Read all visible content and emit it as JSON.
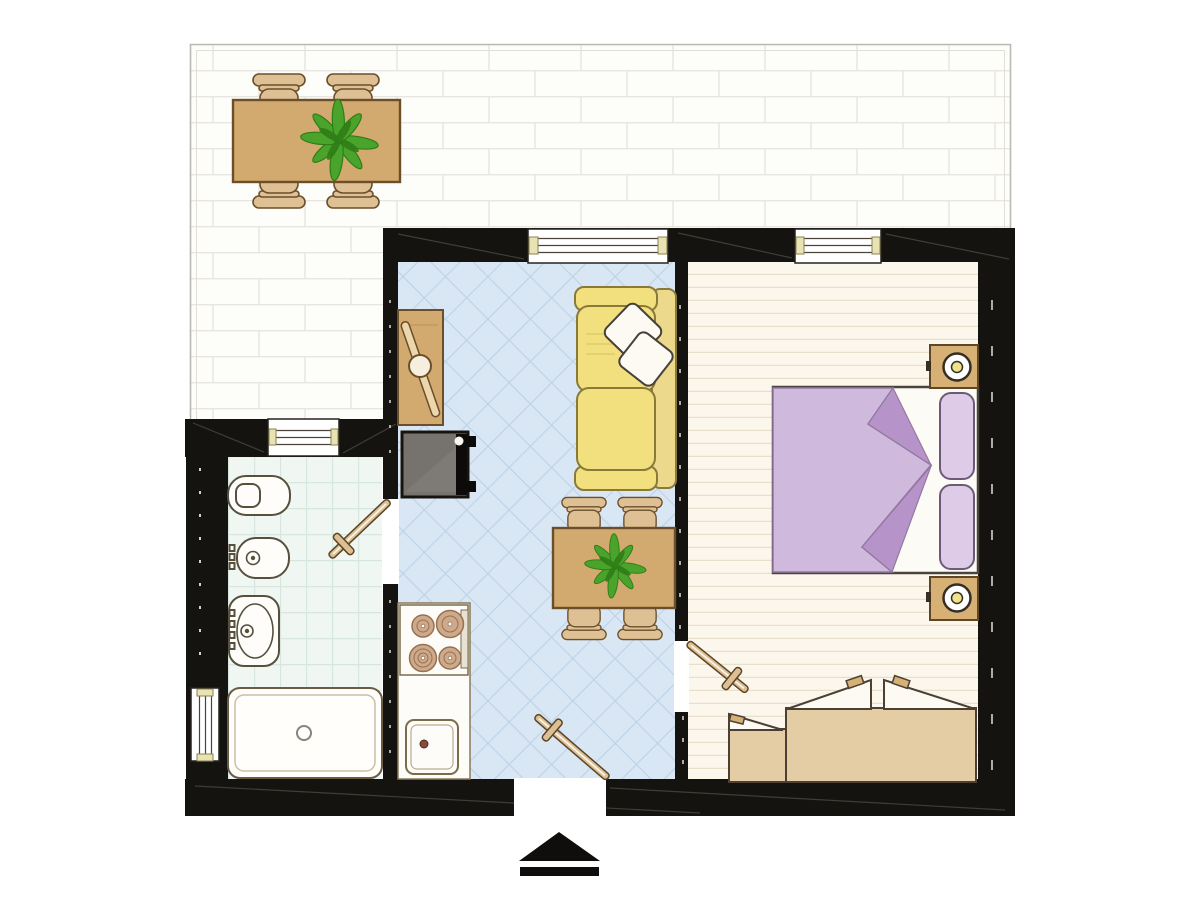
{
  "image": {
    "type": "floor-plan",
    "subject": "one-bedroom apartment with terrace",
    "text_labels": []
  },
  "colors": {
    "wall": "#151310",
    "terrace_bg": "#fdfdfa",
    "terrace_line": "#e9e6e1",
    "terrace_border": "#bcb9b4",
    "living_floor": "#d9e7f4",
    "living_line": "#bdd2e7",
    "bath_floor": "#f0f7f3",
    "bath_line": "#d7e6de",
    "bedroom_floor": "#fbf7ec",
    "plank_line": "#e8e0cb",
    "wood": "#d2a96e",
    "wood_light": "#dfc094",
    "wood_dark": "#6b4f2a",
    "sofa": "#f2e07e",
    "sofa_dark": "#ecd98c",
    "sofa_border": "#8a7a3a",
    "duvet": "#cfb9dd",
    "duvet_fold": "#b694c9",
    "bed_pillow": "#ddcbe8",
    "door_wood": "#dcc094",
    "tv": "#76726d",
    "plant": "#4aa42c",
    "plant_dark": "#2f7d16",
    "fixture": "#fefdfa",
    "fixture_stroke": "#57503f",
    "arrow": "#0f0e0c"
  },
  "rooms": [
    {
      "id": "terrace",
      "floor": "white-brick-tiles",
      "furniture": [
        "outdoor-dining-table",
        "outdoor-chair",
        "outdoor-chair",
        "outdoor-chair",
        "outdoor-chair",
        "potted-plant"
      ]
    },
    {
      "id": "living-room",
      "floor": "blue-diamond-tiles",
      "furniture": [
        "sofa",
        "throw-pillow",
        "throw-pillow",
        "console-table",
        "tv-unit",
        "dining-table",
        "dining-chair",
        "dining-chair",
        "dining-chair",
        "dining-chair",
        "potted-plant"
      ]
    },
    {
      "id": "kitchen-area",
      "floor": "blue-diamond-tiles",
      "furniture": [
        "cooktop-four-burners",
        "kitchen-counter",
        "kitchen-sink"
      ]
    },
    {
      "id": "bathroom",
      "floor": "white-grid-tiles",
      "furniture": [
        "toilet",
        "bidet",
        "washbasin",
        "bathtub"
      ]
    },
    {
      "id": "bedroom",
      "floor": "wood-planks",
      "furniture": [
        "double-bed",
        "bed-pillow",
        "bed-pillow",
        "nightstand",
        "nightstand",
        "table-lamp",
        "table-lamp",
        "wardrobe",
        "cabinet"
      ]
    }
  ],
  "openings": {
    "windows": 4,
    "interior_doors": 3,
    "entrance": "bottom-center gap in exterior wall"
  },
  "compass": {
    "type": "north-arrow",
    "glyph": "solid-triangle-with-bar",
    "direction": "up",
    "position": "bottom-center"
  }
}
